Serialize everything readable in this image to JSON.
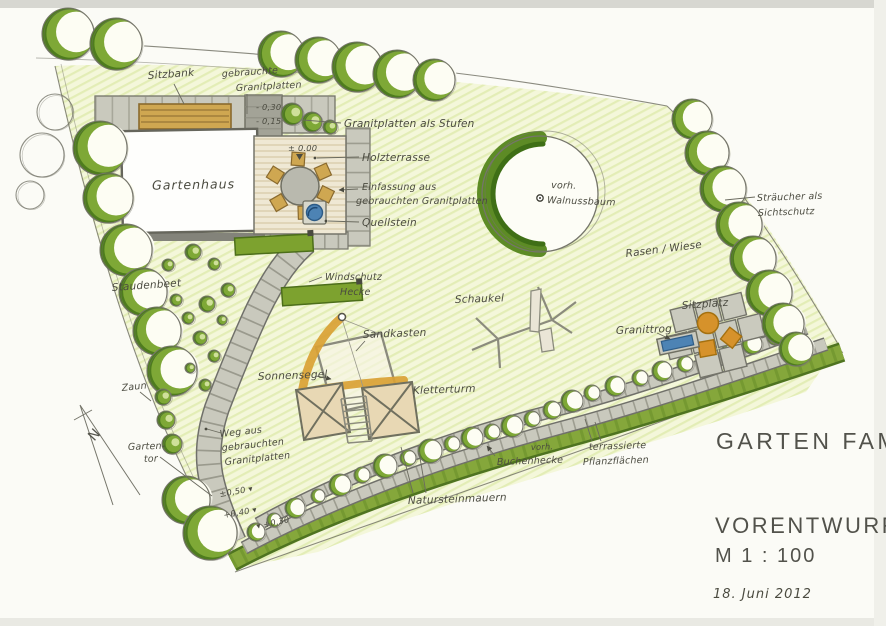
{
  "title_block": {
    "project": "GARTEN FAM.",
    "stage": "VORENTWURF",
    "scale": "M 1 : 100",
    "date": "18. Juni 2012"
  },
  "labels": {
    "gartenhaus": "Gartenhaus",
    "sitzbank": "Sitzbank",
    "granitplatten_line1": "gebrauchte",
    "granitplatten_line2": "Granitplatten",
    "stufen": "Granitplatten als Stufen",
    "holzterrasse": "Holzterrasse",
    "einfassung_line1": "Einfassung aus",
    "einfassung_line2": "gebrauchten Granitplatten",
    "quellstein": "Quellstein",
    "windschutz_line1": "Windschutz",
    "windschutz_line2": "Hecke",
    "staudenbeet": "Staudenbeet",
    "zaun": "Zaun",
    "sonnensegel": "Sonnensegel",
    "sandkasten": "Sandkasten",
    "kletterturm": "Kletterturm",
    "schaukel": "Schaukel",
    "walnussbaum_line1": "vorh.",
    "walnussbaum_line2": "Walnussbaum",
    "rasen_wiese": "Rasen / Wiese",
    "sichtschutz_line1": "Sträucher als",
    "sichtschutz_line2": "Sichtschutz",
    "sitzplatz": "Sitzplatz",
    "granittrog": "Granittrog",
    "weg_line1": "Weg aus",
    "weg_line2": "gebrauchten",
    "weg_line3": "Granitplatten",
    "gartentor_line1": "Garten-",
    "gartentor_line2": "tor",
    "natursteinmauern": "Natursteinmauern",
    "buchenhecke_line1": "vorh.",
    "buchenhecke_line2": "Buchenhecke",
    "pflanzflaechen_line1": "terrassierte",
    "pflanzflaechen_line2": "Pflanzflächen",
    "north": "N"
  },
  "elevations": {
    "terrace": "± 0.00",
    "steps_upper": "- 0,30",
    "steps_lower": "- 0,15",
    "slope_upper": "±0,50 ▾",
    "slope_mid": "+0,40 ▾",
    "slope_lower": "▾ +0,30"
  },
  "colors": {
    "paper": "#fbfbf6",
    "lawn": "#f4f7da",
    "lawn_hatch": "#e3edb6",
    "tree_dark": "#4e7c1e",
    "tree_mid": "#7ea836",
    "tree_light": "#fdfdf3",
    "hedge": "#85a73b",
    "hedge_dark": "#4f7420",
    "stone": "#c9c9bd",
    "stone_joint": "#8a8a7e",
    "stone_dark": "#9c9c90",
    "wood": "#efe8d4",
    "wood_line": "#d5c6a2",
    "bench": "#cfa751",
    "play_orange": "#d9a134",
    "seat_orange": "#d6922b",
    "water": "#4d83b4",
    "pencil": "#75756a",
    "ink": "#4b4b40"
  }
}
